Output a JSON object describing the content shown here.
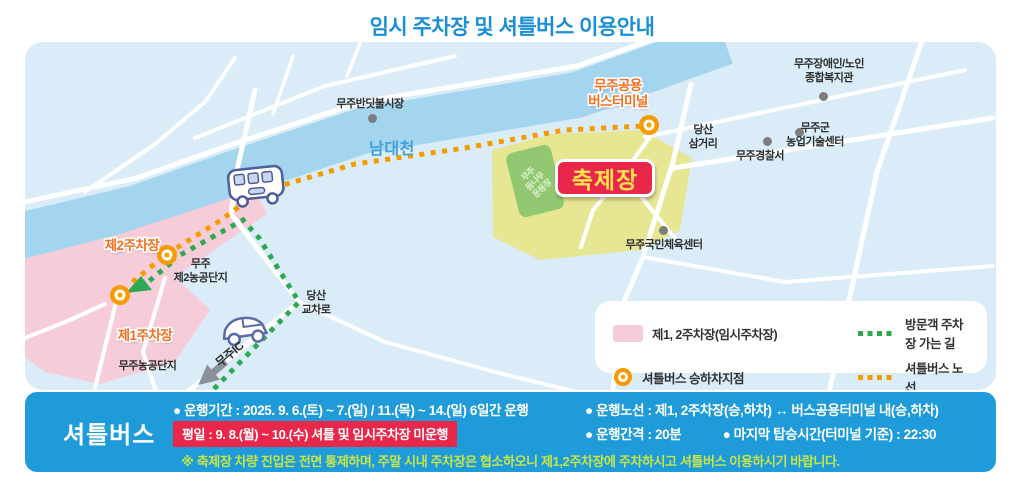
{
  "title": "임시 주차장 및 셔틀버스 이용안내",
  "map": {
    "river": "남대천",
    "places": {
      "market": "무주반딧불시장",
      "terminal": [
        "무주공용",
        "버스터미널"
      ],
      "welfare": [
        "무주장애인/노인",
        "종합복지관"
      ],
      "dangsan_samgeori": [
        "당산",
        "삼거리"
      ],
      "police": "무주경찰서",
      "agri_center": [
        "무주군",
        "농업기술센터"
      ],
      "festival": "축제장",
      "field": [
        "무주",
        "등나무",
        "운동장"
      ],
      "sports_center": "무주국민체육센터",
      "parking2": "제2주차장",
      "complex2": [
        "무주",
        "제2농공단지"
      ],
      "parking1": "제1주차장",
      "complex1": "무주농공단지",
      "dangsan_crossing": [
        "당산",
        "교차로"
      ],
      "ic": "무주IC"
    }
  },
  "legend": {
    "parking": "제1, 2주차장(임시주차장)",
    "visitor_route": "방문객 주차장 가는 길",
    "stop": "셔틀버스 승하차지점",
    "bus_route": "셔틀버스 노선"
  },
  "shuttle": {
    "heading": "셔틀버스",
    "period": "● 운행기간 : 2025. 9. 6.(토) ~ 7.(일) / 11.(목) ~ 14.(일)  6일간 운행",
    "weekday_notice": "평일 : 9. 8.(월) ~ 10.(수) 셔틀 및 임시주차장 미운행",
    "route": "● 운행노선 : 제1, 2주차장(승,하차) ↔ 버스공용터미널 내(승,하차)",
    "interval": "● 운행간격 : 20분",
    "last_boarding": "● 마지막 탑승시간(터미널 기준) : 22:30",
    "note": "※ 축제장 차량 진입은 전면 통제하며, 주말 시내 주차장은 협소하오니 제1,2주차장에 주차하시고 셔틀버스 이용하시기 바랍니다."
  },
  "colors": {
    "title_blue": "#1B8ED6",
    "bar_blue": "#1E9BD8",
    "map_bg": "#D9ECF8",
    "river_blue": "#A4D5EF",
    "road_white": "#FFFFFF",
    "parking_pink": "#F6CCD9",
    "festival_yellow": "#E7E793",
    "field_green": "#93C873",
    "shuttle_orange": "#F59B00",
    "visitor_green": "#2FA853",
    "alert_red": "#E8274B",
    "badge_text_yellow": "#FFE14D",
    "note_green": "#C6E54A",
    "orange_label": "#F26F21"
  }
}
